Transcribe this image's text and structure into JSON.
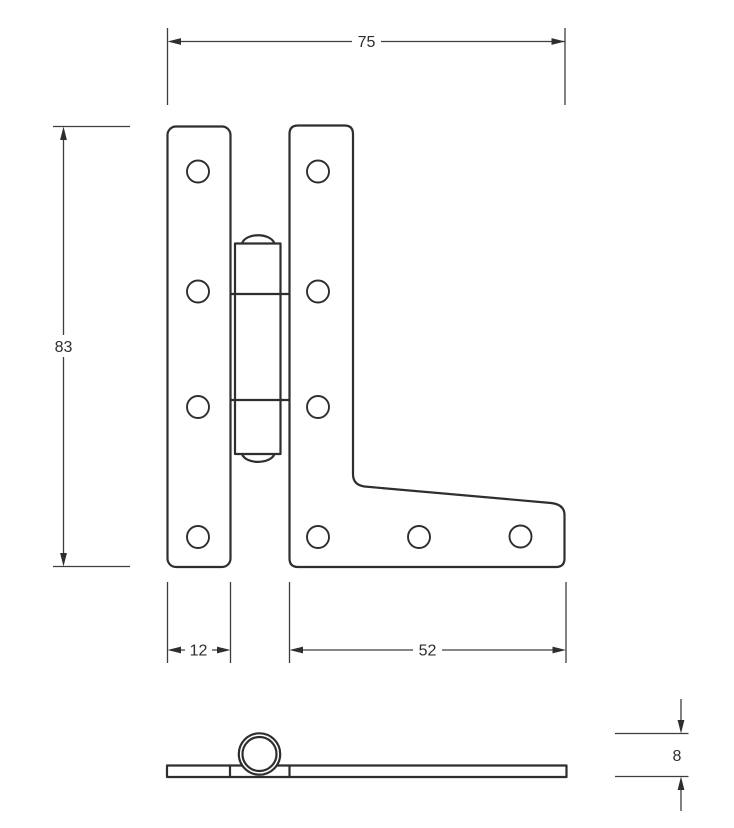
{
  "drawing": {
    "type": "technical-orthographic-drawing",
    "subject": "HL cabinet hinge, front view and bottom profile view",
    "line_color": "#2e2e2e",
    "background_color": "#ffffff",
    "dimensions": {
      "overall_width": "75",
      "overall_height": "83",
      "narrow_leaf_width": "12",
      "bottom_flange_width": "52",
      "barrel_thickness": "8"
    }
  }
}
